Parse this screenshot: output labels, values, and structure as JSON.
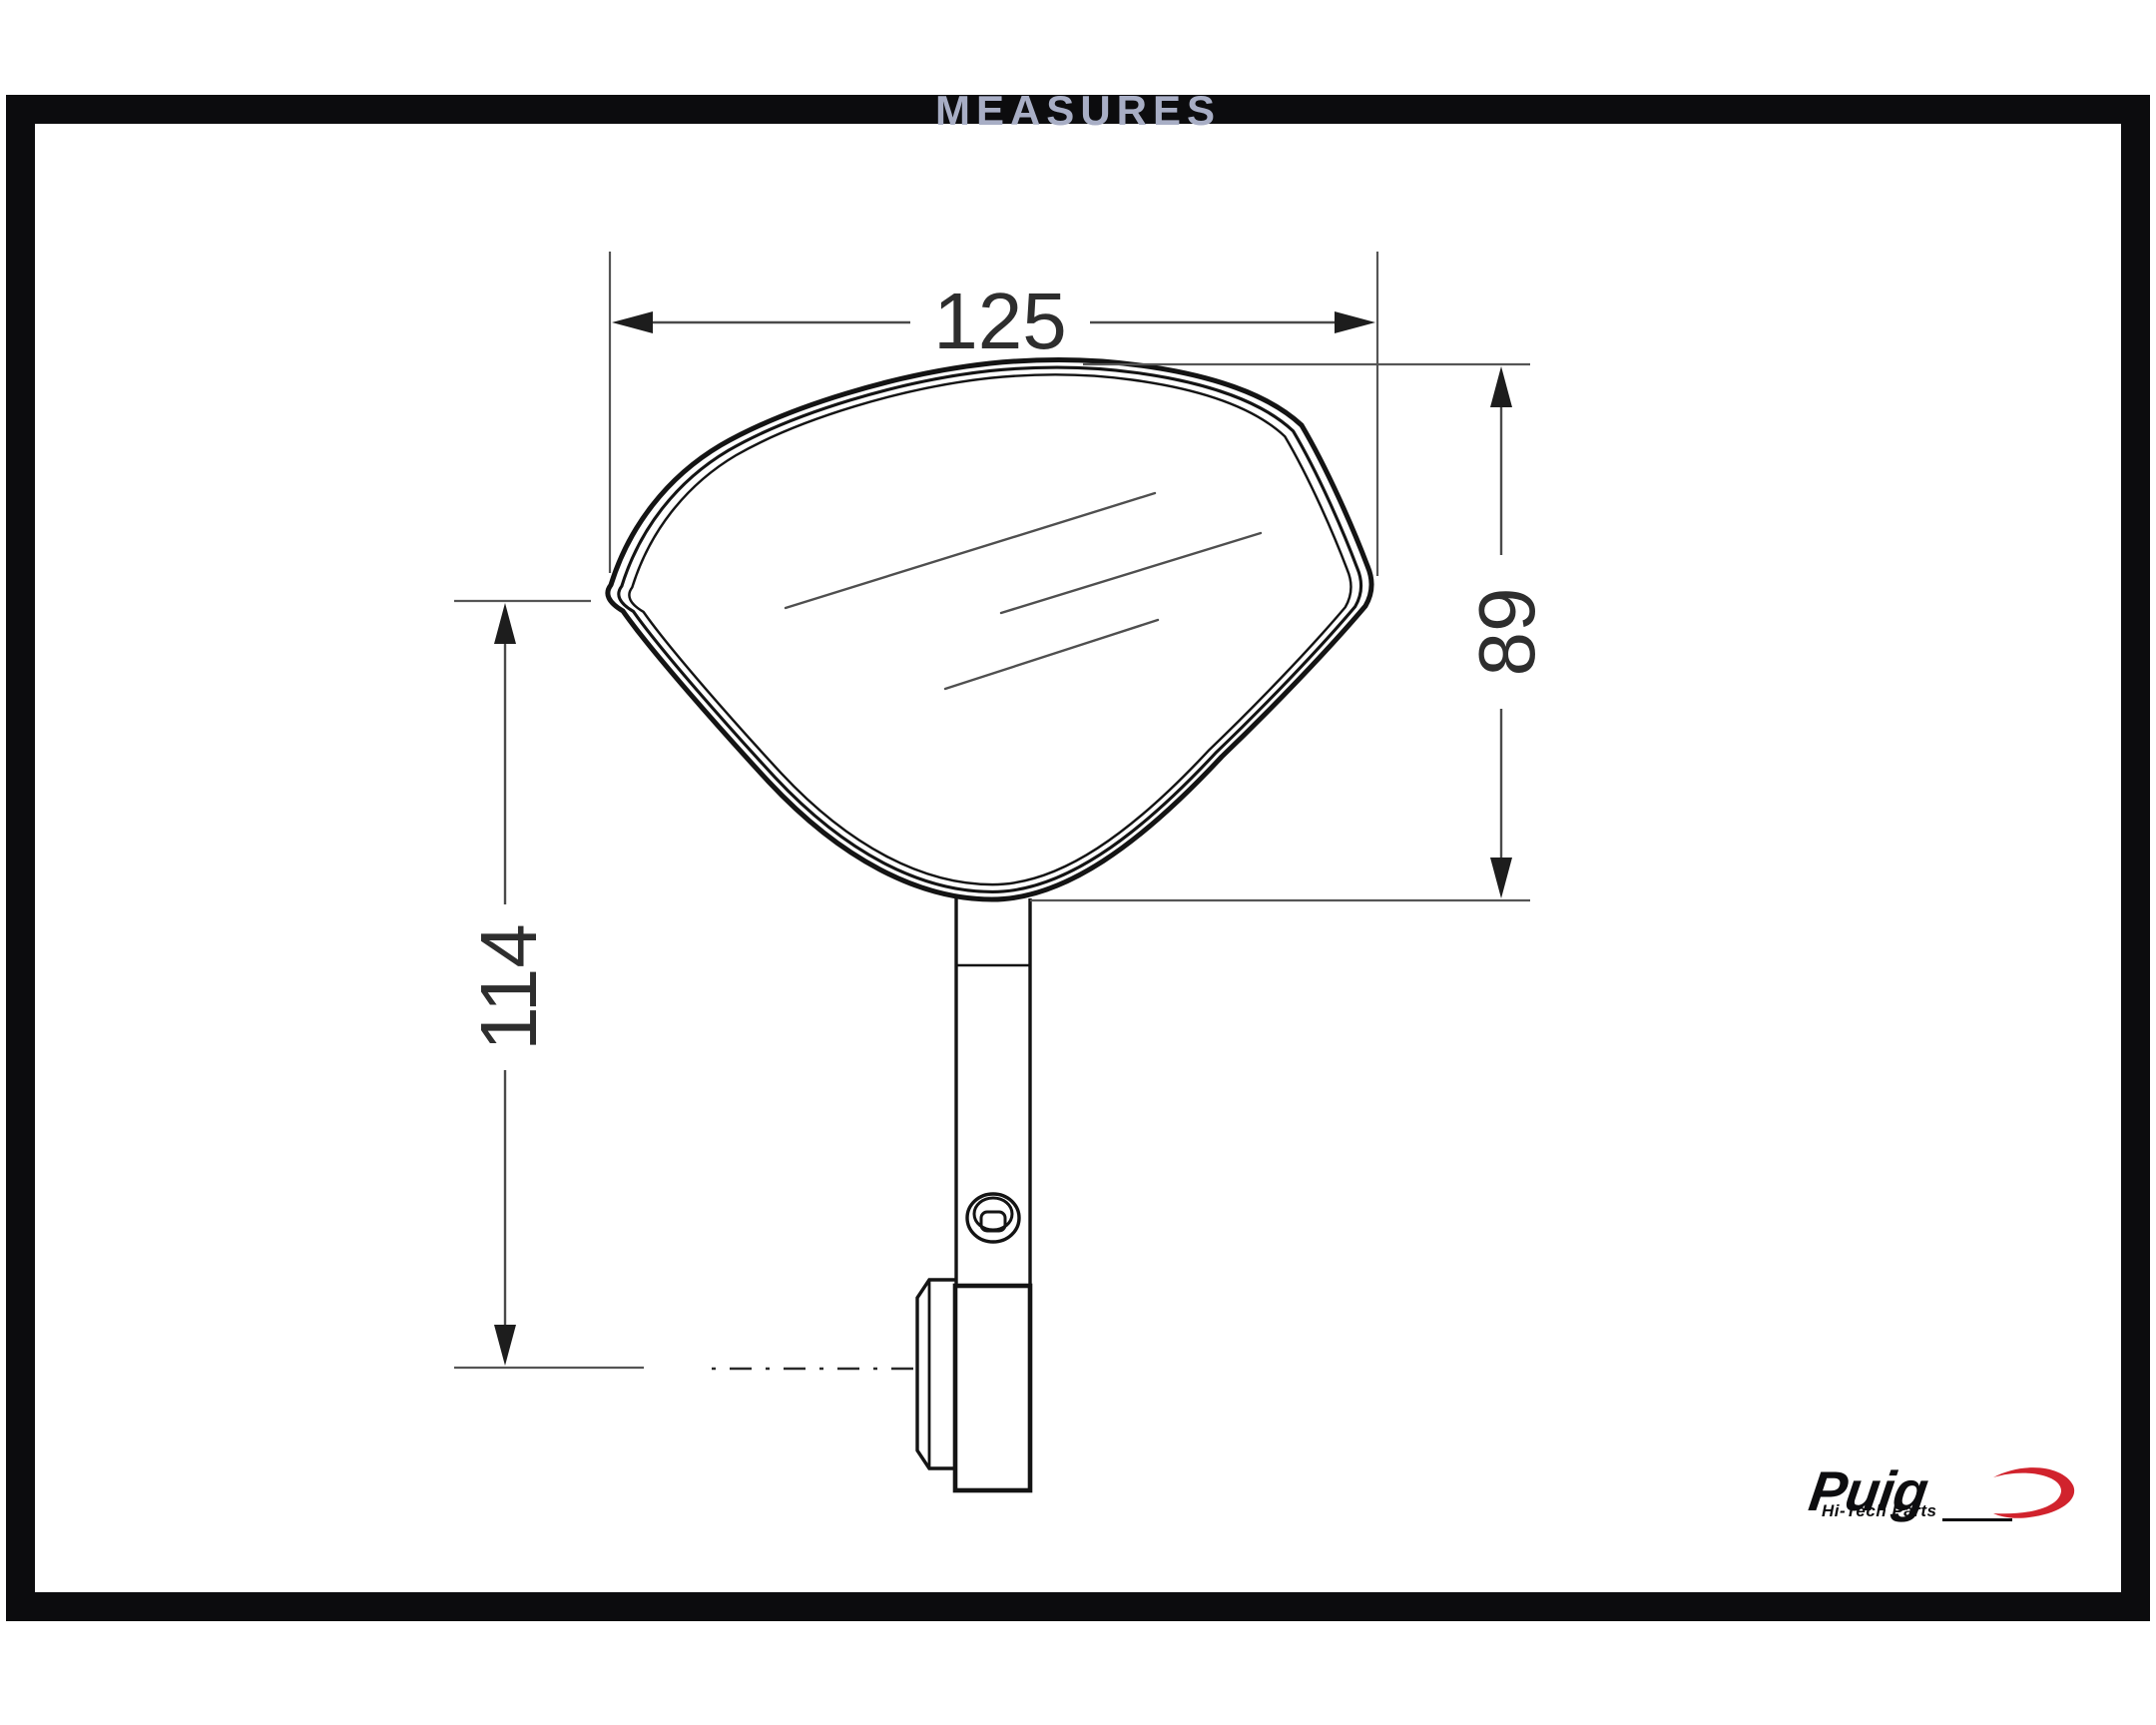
{
  "title": "MEASURES",
  "drawing": {
    "dim_width": "125",
    "dim_height": "89",
    "dim_stem": "114"
  },
  "logo": {
    "brand": "Puig",
    "tagline": "Hi-Tech Parts"
  },
  "colors": {
    "title_gray": "#a8aec5",
    "frame_black": "#0c0c0e",
    "line_dark": "#141414",
    "dim_gray": "#4a4a4a",
    "accent_red": "#d1232d"
  }
}
